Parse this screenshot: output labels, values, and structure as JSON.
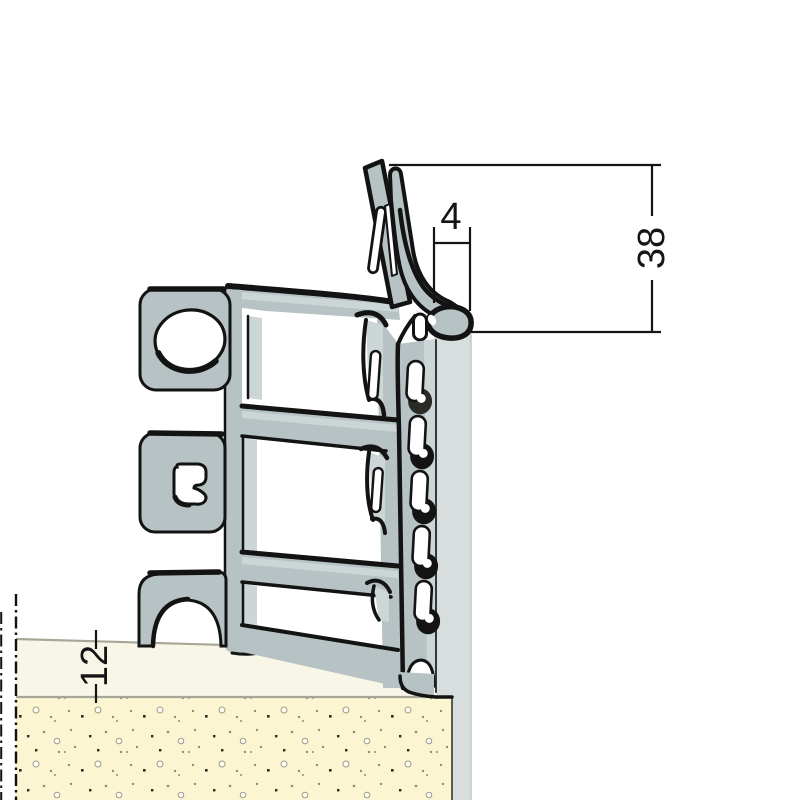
{
  "drawing": {
    "dimensions": {
      "bead_gap": {
        "label": "4"
      },
      "flange_height": {
        "label": "38"
      },
      "render_thickness": {
        "label": "12"
      }
    },
    "colors": {
      "steel": "#b6c2c3",
      "steel_light": "#cdd6d6",
      "steel_dark": "#9aabae",
      "band": "#d8dedd",
      "outline": "#131313",
      "render_base": "#f8f6e6",
      "render_stipple": "#fbf5d1",
      "edge_line": "#a8a797",
      "dim_color": "#151515"
    }
  }
}
